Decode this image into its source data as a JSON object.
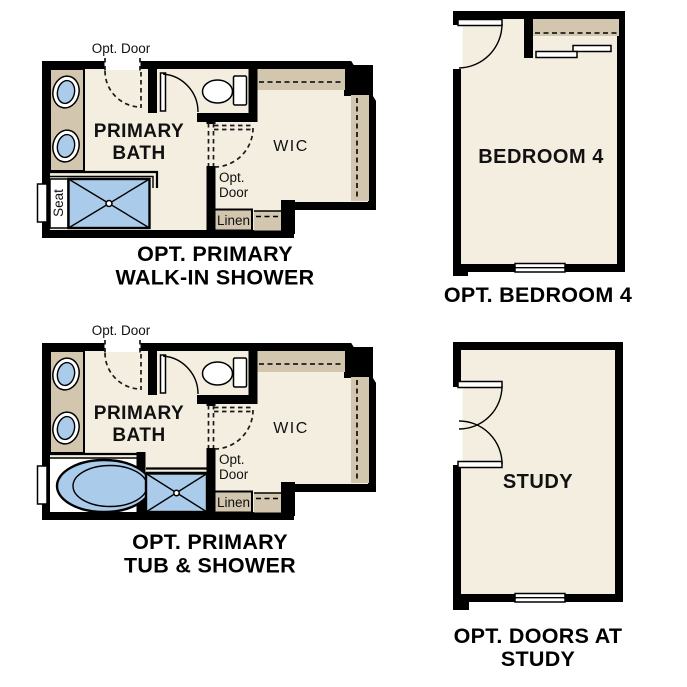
{
  "colors": {
    "page": "#ffffff",
    "wall": "#000000",
    "floor": "#f4eee1",
    "tan": "#d3c6ae",
    "blue": "#aacbea",
    "text": "#111111"
  },
  "plans": {
    "walk_in_shower": {
      "labels": {
        "opt_door_top": "Opt. Door",
        "room_line1": "PRIMARY",
        "room_line2": "BATH",
        "wic": "WIC",
        "opt_door_mid_line1": "Opt.",
        "opt_door_mid_line2": "Door",
        "linen": "Linen",
        "seat": "Seat"
      },
      "caption_line1": "OPT. PRIMARY",
      "caption_line2": "WALK-IN SHOWER"
    },
    "bedroom4": {
      "labels": {
        "room": "BEDROOM 4"
      },
      "caption_line1": "OPT. BEDROOM 4"
    },
    "tub_shower": {
      "labels": {
        "opt_door_top": "Opt. Door",
        "room_line1": "PRIMARY",
        "room_line2": "BATH",
        "wic": "WIC",
        "opt_door_mid_line1": "Opt.",
        "opt_door_mid_line2": "Door",
        "linen": "Linen"
      },
      "caption_line1": "OPT. PRIMARY",
      "caption_line2": "TUB & SHOWER"
    },
    "study": {
      "labels": {
        "room": "STUDY"
      },
      "caption_line1": "OPT. DOORS AT",
      "caption_line2": "STUDY"
    }
  }
}
